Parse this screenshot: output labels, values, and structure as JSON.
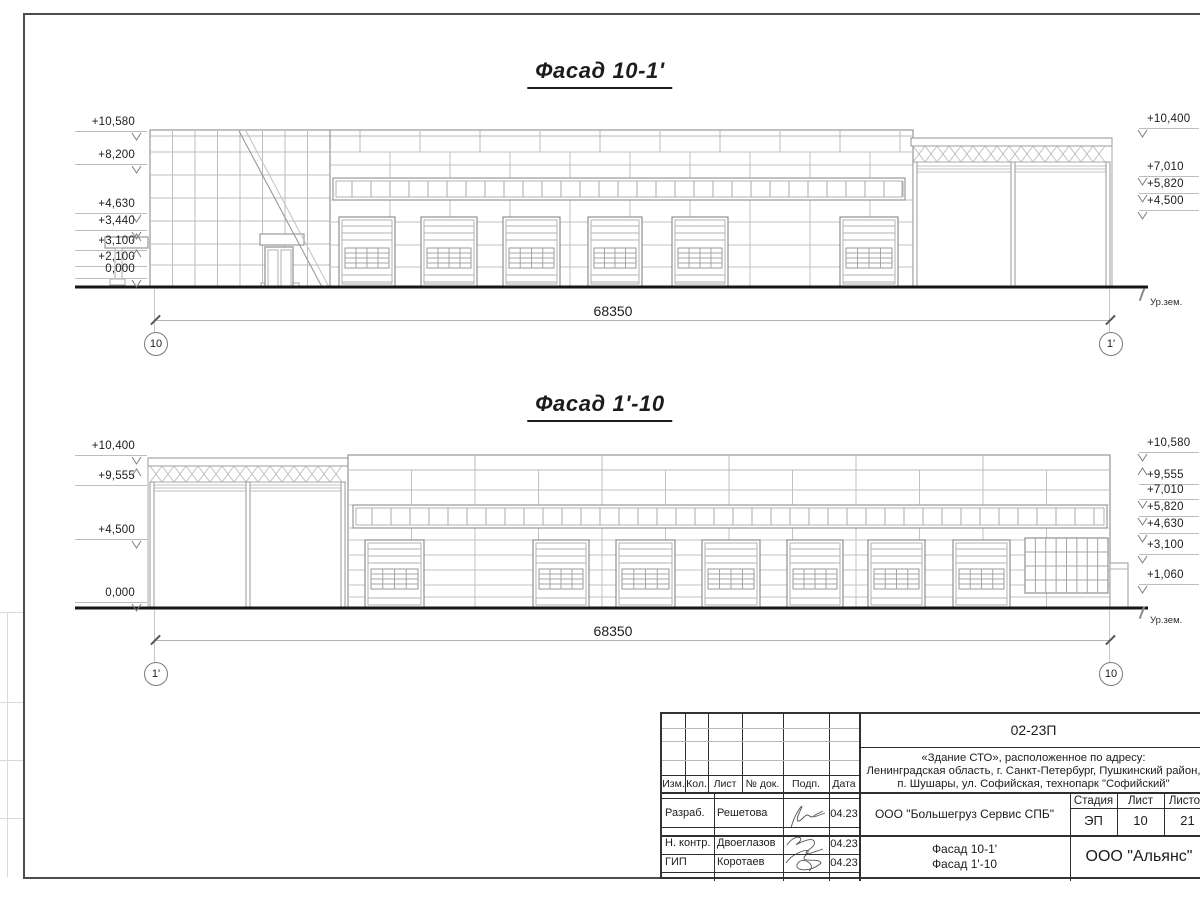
{
  "facades": [
    {
      "title": "Фасад 10-1'",
      "dimension_label": "68350",
      "axis_left": "10",
      "axis_right": "1'",
      "ground_label": "Ур.зем.",
      "marks_left": [
        {
          "label": "+10,580",
          "dir": "down"
        },
        {
          "label": "+8,200",
          "dir": "down"
        },
        {
          "label": "+4,630",
          "dir": "down"
        },
        {
          "label": "+3,440",
          "dir": "down"
        },
        {
          "label": "+3,100",
          "dir": "up"
        },
        {
          "label": "+2,100",
          "dir": "up"
        },
        {
          "label": "0,000",
          "dir": "down"
        }
      ],
      "marks_right": [
        {
          "label": "+10,400",
          "dir": "down"
        },
        {
          "label": "+7,010",
          "dir": "down"
        },
        {
          "label": "+5,820",
          "dir": "down"
        },
        {
          "label": "+4,500",
          "dir": "down"
        }
      ]
    },
    {
      "title": "Фасад 1'-10",
      "dimension_label": "68350",
      "axis_left": "1'",
      "axis_right": "10",
      "ground_label": "Ур.зем.",
      "marks_left": [
        {
          "label": "+10,400",
          "dir": "down"
        },
        {
          "label": "+9,555",
          "dir": "up"
        },
        {
          "label": "+4,500",
          "dir": "down"
        },
        {
          "label": "0,000",
          "dir": "down"
        }
      ],
      "marks_right": [
        {
          "label": "+10,580",
          "dir": "down"
        },
        {
          "label": "+9,555",
          "dir": "up"
        },
        {
          "label": "+7,010",
          "dir": "down"
        },
        {
          "label": "+5,820",
          "dir": "down"
        },
        {
          "label": "+4,630",
          "dir": "down"
        },
        {
          "label": "+3,100",
          "dir": "down"
        },
        {
          "label": "+1,060",
          "dir": "down"
        }
      ]
    }
  ],
  "titleblock": {
    "doc_code": "02-23П",
    "object_address": {
      "line1": "«Здание СТО», расположенное по адресу:",
      "line2": "Ленинградская область, г. Санкт-Петербург, Пушкинский район,",
      "line3": "п. Шушары, ул. Софийская, технопарк \"Софийский\""
    },
    "header_cells": [
      "Изм.",
      "Кол.",
      "Лист",
      "№ док.",
      "Подп.",
      "Дата"
    ],
    "roles": [
      {
        "role": "Разраб.",
        "name": "Решетова",
        "date": "04.23"
      },
      {
        "role": "Н. контр.",
        "name": "Двоеглазов",
        "date": "04.23"
      },
      {
        "role": "ГИП",
        "name": "Коротаев",
        "date": "04.23"
      }
    ],
    "customer": "ООО \"Большегруз Сервис СПБ\"",
    "stage_header": [
      "Стадия",
      "Лист",
      "Листов"
    ],
    "stage": "ЭП",
    "sheet_number": "10",
    "sheet_total": "21",
    "drawing_title_line1": "Фасад 10-1'",
    "drawing_title_line2": "Фасад 1'-10",
    "organization": "ООО \"Альянс\""
  }
}
